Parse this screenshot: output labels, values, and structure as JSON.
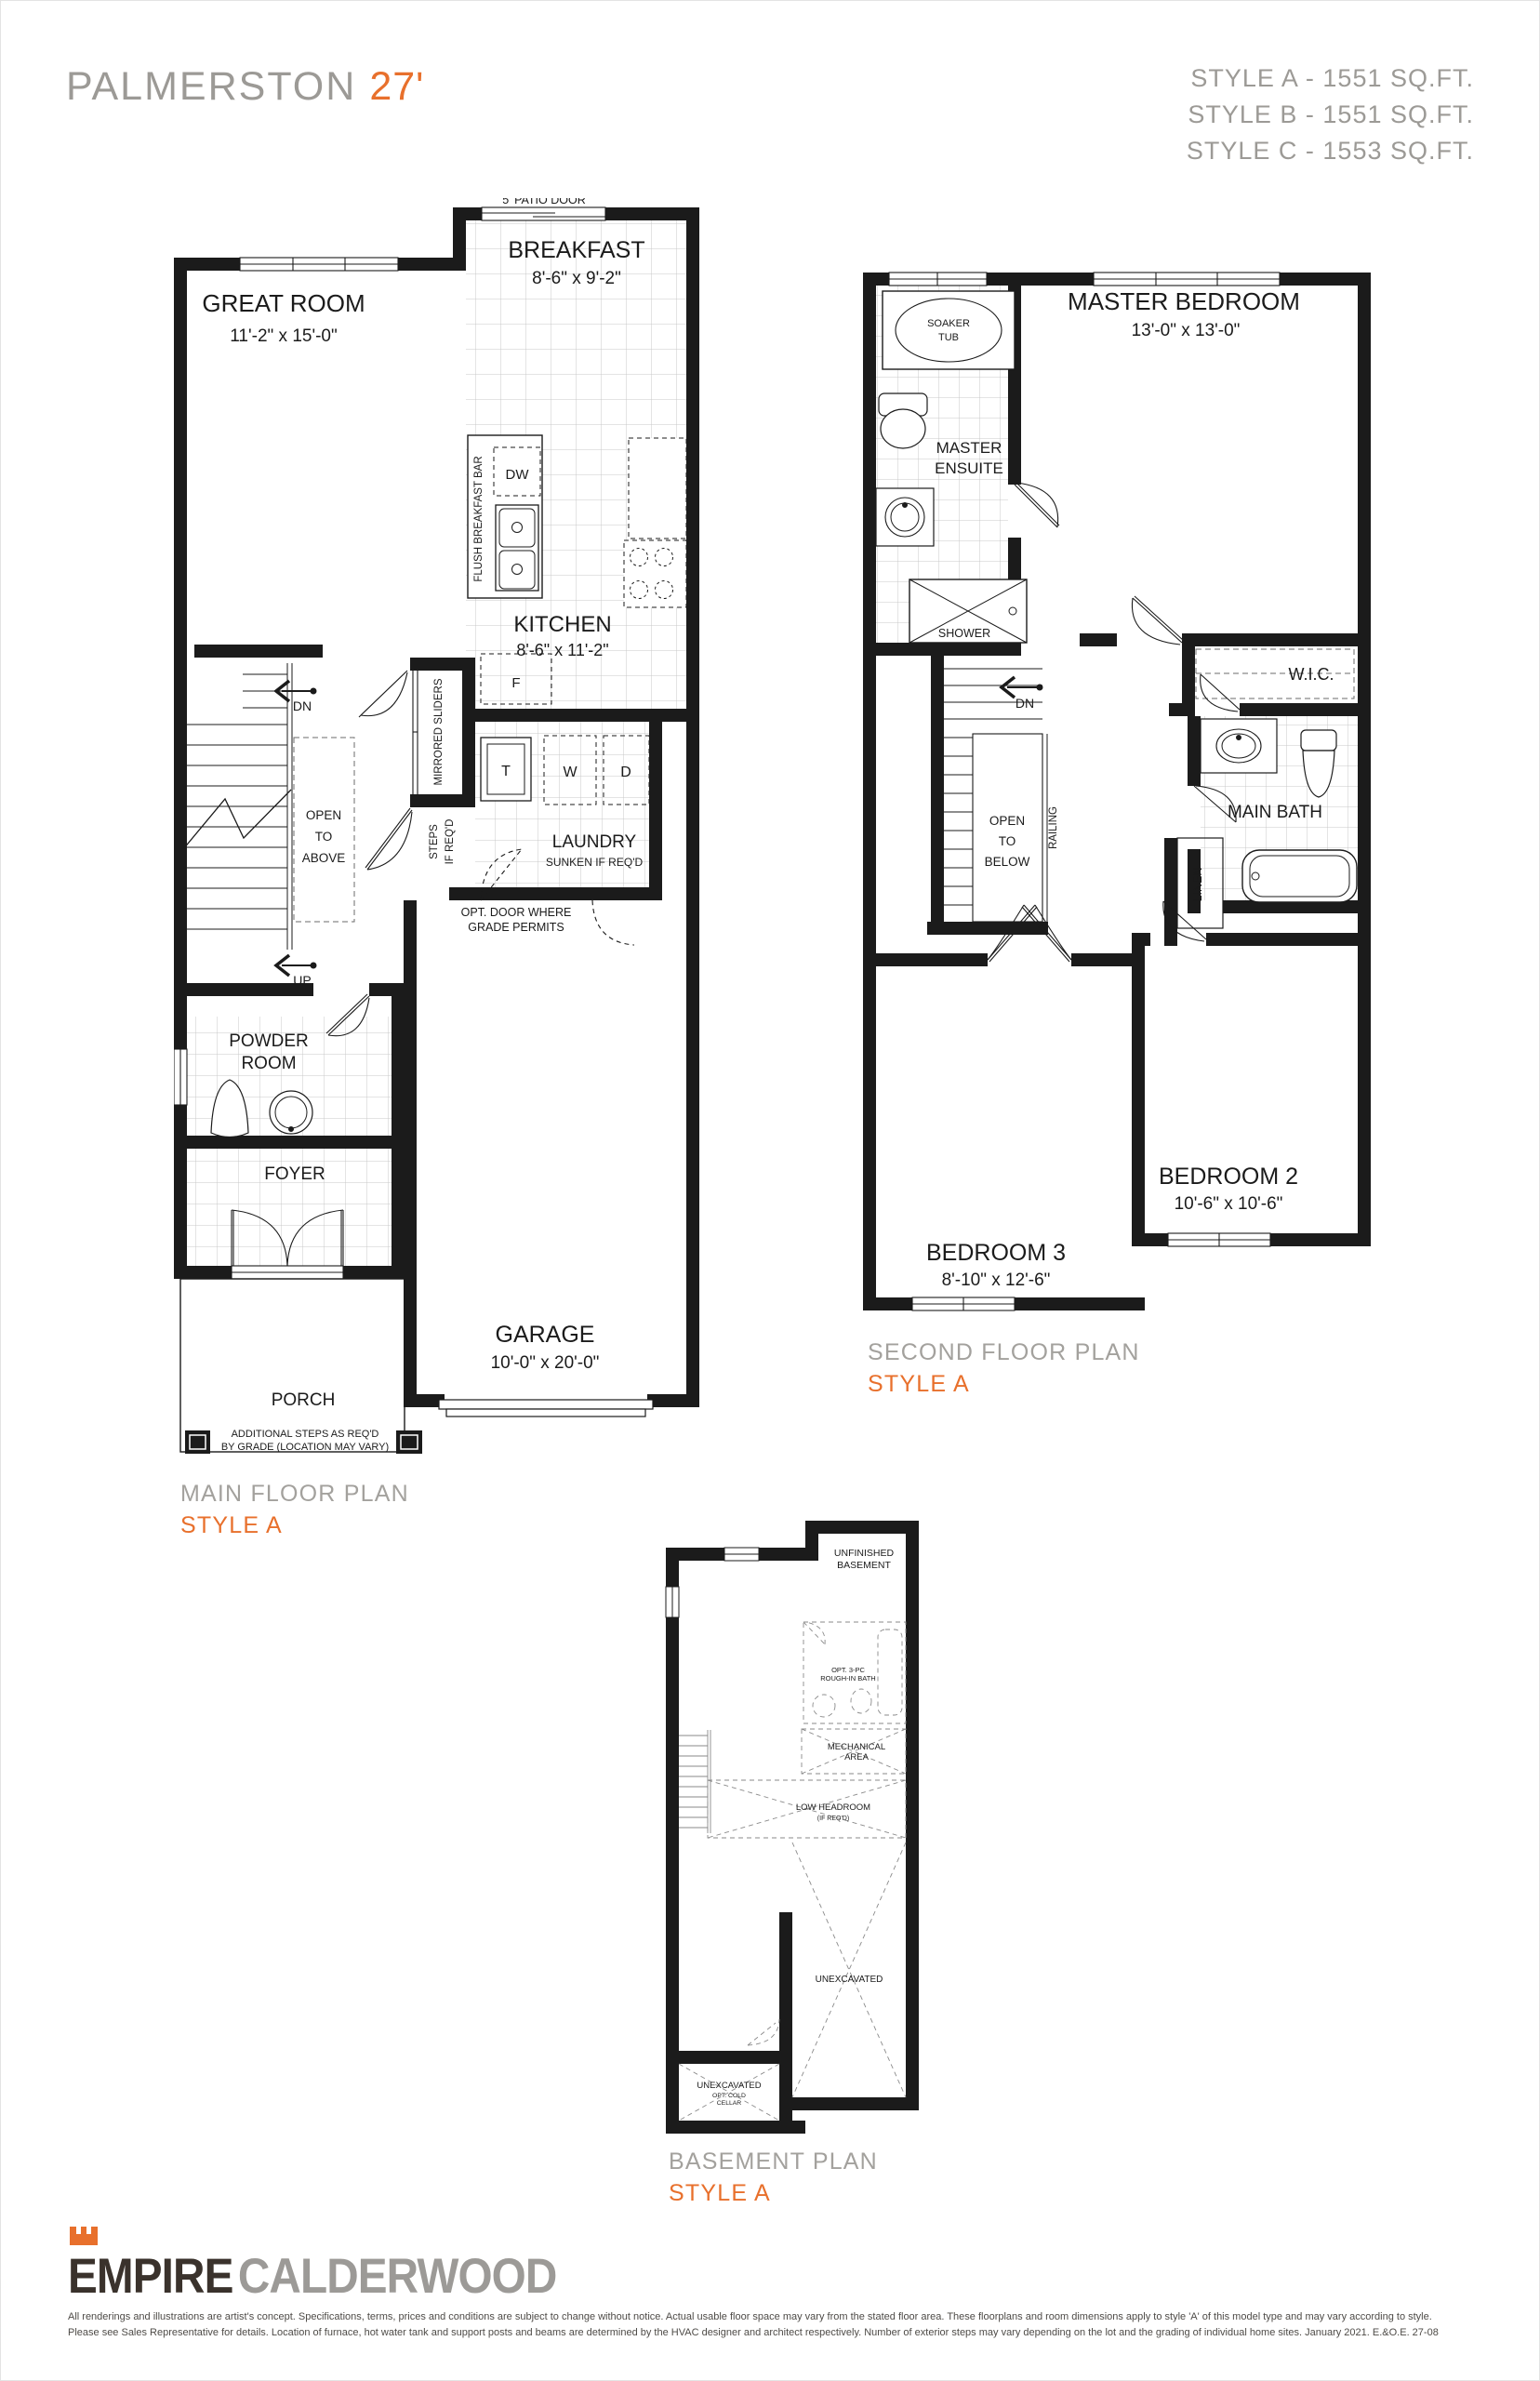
{
  "colors": {
    "accent": "#e8702c",
    "gray_text": "#9c9a96",
    "plan_black": "#1b1b1b",
    "logo_dark": "#3a322c",
    "logo_gray": "#9c9a97"
  },
  "header": {
    "title": "PALMERSTON",
    "title_size": "27'",
    "styles": [
      "STYLE A - 1551 SQ.FT.",
      "STYLE B - 1551 SQ.FT.",
      "STYLE C - 1553 SQ.FT."
    ]
  },
  "main_floor": {
    "caption": "MAIN FLOOR PLAN",
    "style": "STYLE A",
    "patio_door": "5' PATIO DOOR",
    "breakfast": "BREAKFAST",
    "breakfast_dims": "8'-6\" x 9'-2\"",
    "great_room": "GREAT ROOM",
    "great_room_dims": "11'-2\" x 15'-0\"",
    "kitchen": "KITCHEN",
    "kitchen_dims": "8'-6\" x 11'-2\"",
    "dw": "DW",
    "fridge": "F",
    "flush_breakfast_bar": "FLUSH BREAKFAST BAR",
    "mirrored_sliders": "MIRRORED SLIDERS",
    "steps_1": "STEPS",
    "steps_2": "IF REQ'D",
    "tub": "T",
    "washer": "W",
    "dryer": "D",
    "laundry": "LAUNDRY",
    "laundry_sub": "SUNKEN IF REQ'D",
    "open_above_1": "OPEN",
    "open_above_2": "TO",
    "open_above_3": "ABOVE",
    "dn": "DN",
    "up": "UP",
    "opt_door_1": "OPT. DOOR WHERE",
    "opt_door_2": "GRADE PERMITS",
    "powder_1": "POWDER",
    "powder_2": "ROOM",
    "foyer": "FOYER",
    "garage": "GARAGE",
    "garage_dims": "10'-0\" x 20'-0\"",
    "porch": "PORCH",
    "steps_note_1": "ADDITIONAL STEPS AS REQ'D",
    "steps_note_2": "BY GRADE (LOCATION MAY VARY)"
  },
  "second_floor": {
    "caption": "SECOND FLOOR PLAN",
    "style": "STYLE A",
    "soaker_1": "SOAKER",
    "soaker_2": "TUB",
    "master_bedroom": "MASTER BEDROOM",
    "master_bedroom_dims": "13'-0\" x 13'-0\"",
    "ensuite_1": "MASTER",
    "ensuite_2": "ENSUITE",
    "shower": "SHOWER",
    "wic": "W.I.C.",
    "main_bath": "MAIN BATH",
    "linen": "LINEN",
    "railing": "RAILING",
    "open_below_1": "OPEN",
    "open_below_2": "TO",
    "open_below_3": "BELOW",
    "dn": "DN",
    "bedroom2": "BEDROOM 2",
    "bedroom2_dims": "10'-6\" x 10'-6\"",
    "bedroom3": "BEDROOM 3",
    "bedroom3_dims": "8'-10\" x 12'-6\""
  },
  "basement": {
    "caption": "BASEMENT PLAN",
    "style": "STYLE A",
    "unfinished_1": "UNFINISHED",
    "unfinished_2": "BASEMENT",
    "roughin_1": "OPT. 3-PC",
    "roughin_2": "ROUGH-IN BATH",
    "mechanical_1": "MECHANICAL",
    "mechanical_2": "AREA",
    "low_headroom": "LOW HEADROOM",
    "low_headroom_sub": "(IF REQ'D)",
    "unexcavated": "UNEXCAVATED",
    "cold_1": "UNEXCAVATED",
    "cold_2": "OPT. COLD",
    "cold_3": "CELLAR"
  },
  "footer": {
    "logo_primary": "EMPIRE",
    "logo_secondary": "CALDERWOOD",
    "disclaimer_1": "All renderings and illustrations are artist's concept. Specifications, terms, prices and conditions are subject to change without notice. Actual usable floor space may vary from the stated floor area. These floorplans and room dimensions apply to style 'A' of this model type and may vary according to style.",
    "disclaimer_2": "Please see Sales Representative for details. Location of furnace, hot water tank and support posts and beams are determined by the HVAC designer and architect respectively. Number of exterior steps may vary depending on the lot and the grading of individual home sites. January 2021. E.&O.E. 27-08"
  }
}
